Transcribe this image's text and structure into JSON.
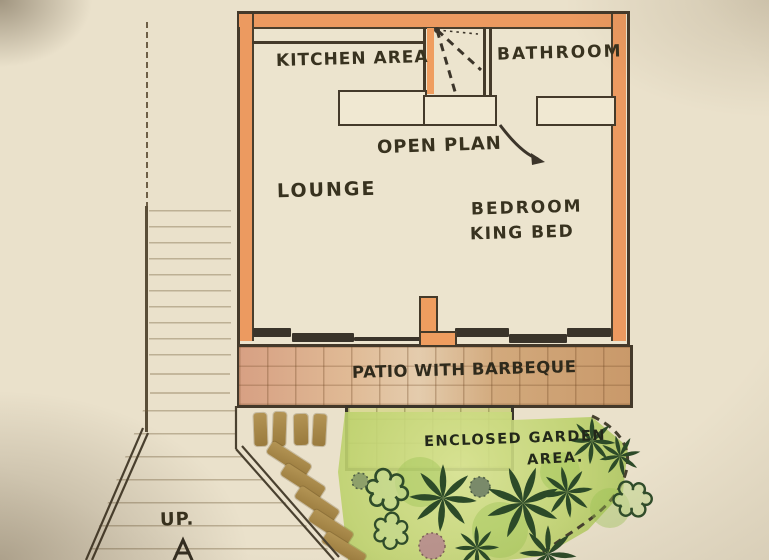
{
  "labels": {
    "kitchen": "KITCHEN AREA",
    "bathroom": "BATHROOM",
    "open_plan": "OPEN PLAN",
    "lounge": "LOUNGE",
    "bedroom": "BEDROOM",
    "bed": "KING BED",
    "patio": "PATIO WITH BARBEQUE",
    "garden_line1": "ENCLOSED GARDEN",
    "garden_line2": "AREA.",
    "up": "UP."
  },
  "colors": {
    "paper": "#eae1cb",
    "wall_orange": "#ec9a60",
    "ink": "#44392a",
    "patio_salmon": "#d7a083",
    "patio_tan": "#c9996a",
    "tile_green": "#d9d795",
    "garden_green": "#bed26e",
    "plant_dark": "#2c4a28",
    "stone_brown": "#a98c4f",
    "text_ink": "#38321f"
  }
}
